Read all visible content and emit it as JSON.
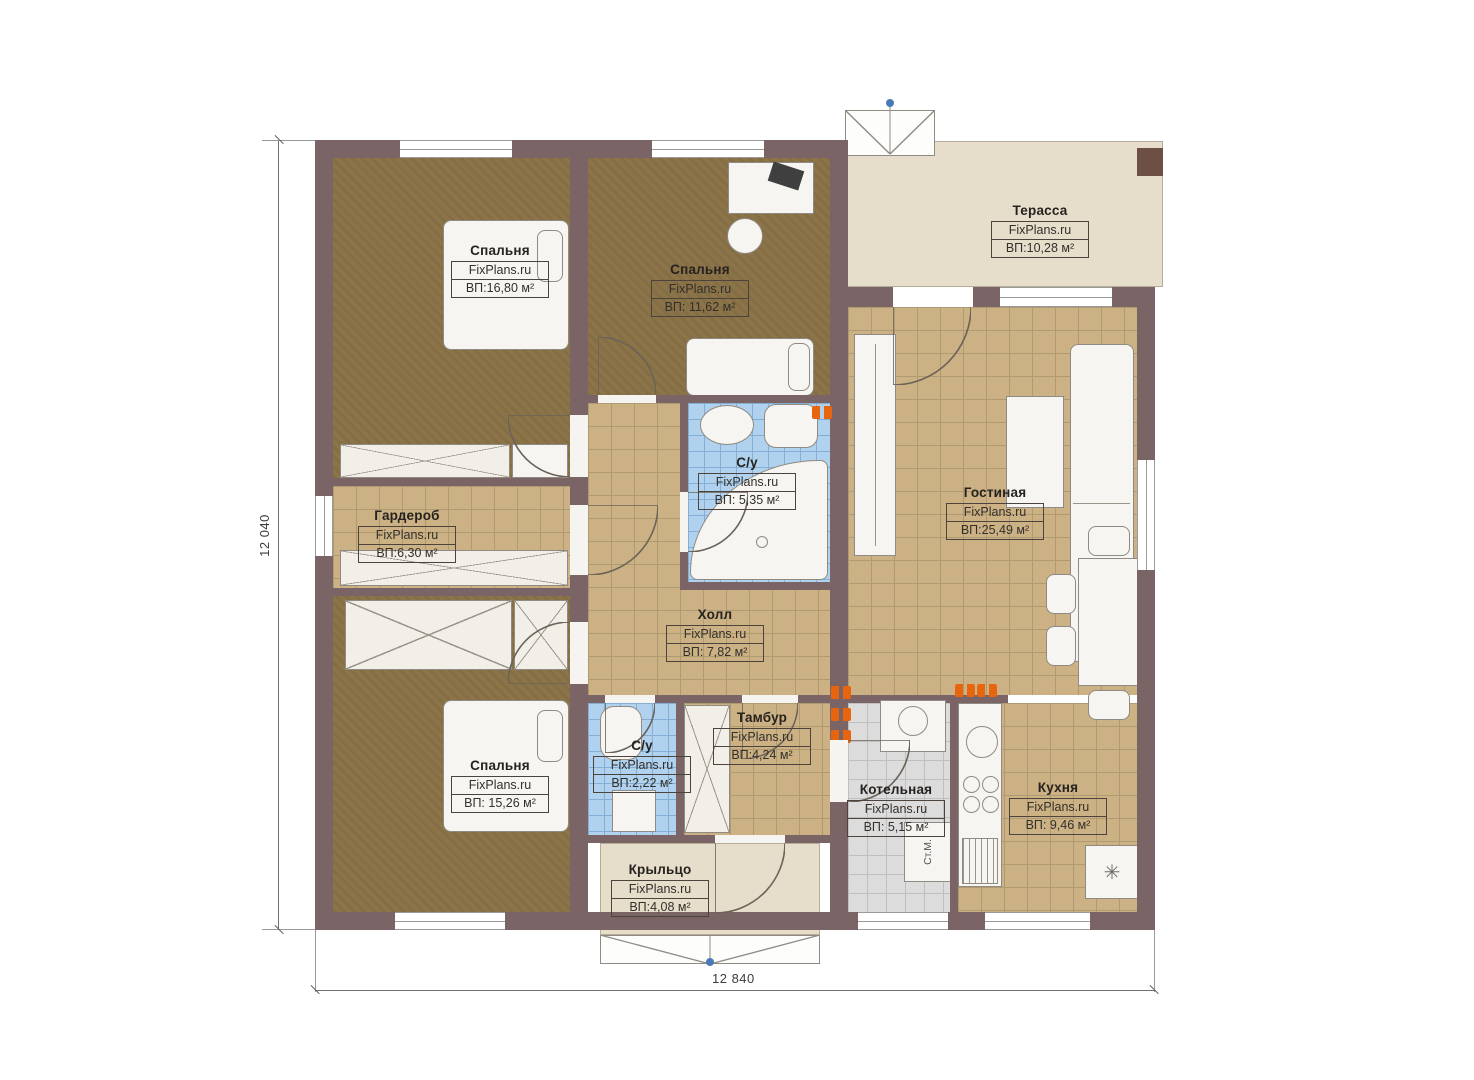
{
  "plan": {
    "brand": "FixPlans.ru",
    "dim_left": "12 040",
    "dim_bottom": "12 840",
    "rooms": [
      {
        "name": "Спальня",
        "area": "ВП:16,80 м²"
      },
      {
        "name": "Спальня",
        "area": "ВП: 11,62 м²"
      },
      {
        "name": "Терасса",
        "area": "ВП:10,28 м²"
      },
      {
        "name": "Гардероб",
        "area": "ВП:6,30 м²"
      },
      {
        "name": "С/у",
        "area": "ВП: 5,35 м²"
      },
      {
        "name": "Гостиная",
        "area": "ВП:25,49 м²"
      },
      {
        "name": "Холл",
        "area": "ВП: 7,82 м²"
      },
      {
        "name": "Спальня",
        "area": "ВП: 15,26 м²"
      },
      {
        "name": "С/у",
        "area": "ВП:2,22 м²"
      },
      {
        "name": "Тамбур",
        "area": "ВП:4,24 м²"
      },
      {
        "name": "Котельная",
        "area": "ВП: 5,15 м²"
      },
      {
        "name": "Кухня",
        "area": "ВП: 9,46 м²"
      },
      {
        "name": "Крыльцо",
        "area": "ВП:4,08 м²"
      }
    ],
    "appliances": {
      "washing_machine": "Ст.М.",
      "fridge_symbol": "✳"
    },
    "colors": {
      "wall": "#7b6466",
      "bedroom_floor": "#8c7449",
      "tile_tan": "#cbb183",
      "tile_blue": "#b0d2ee",
      "tile_gray": "#dcdcdc",
      "outdoor": "#e6ddca",
      "radiator": "#e8650f",
      "stair_dot": "#4a7ab5"
    }
  }
}
